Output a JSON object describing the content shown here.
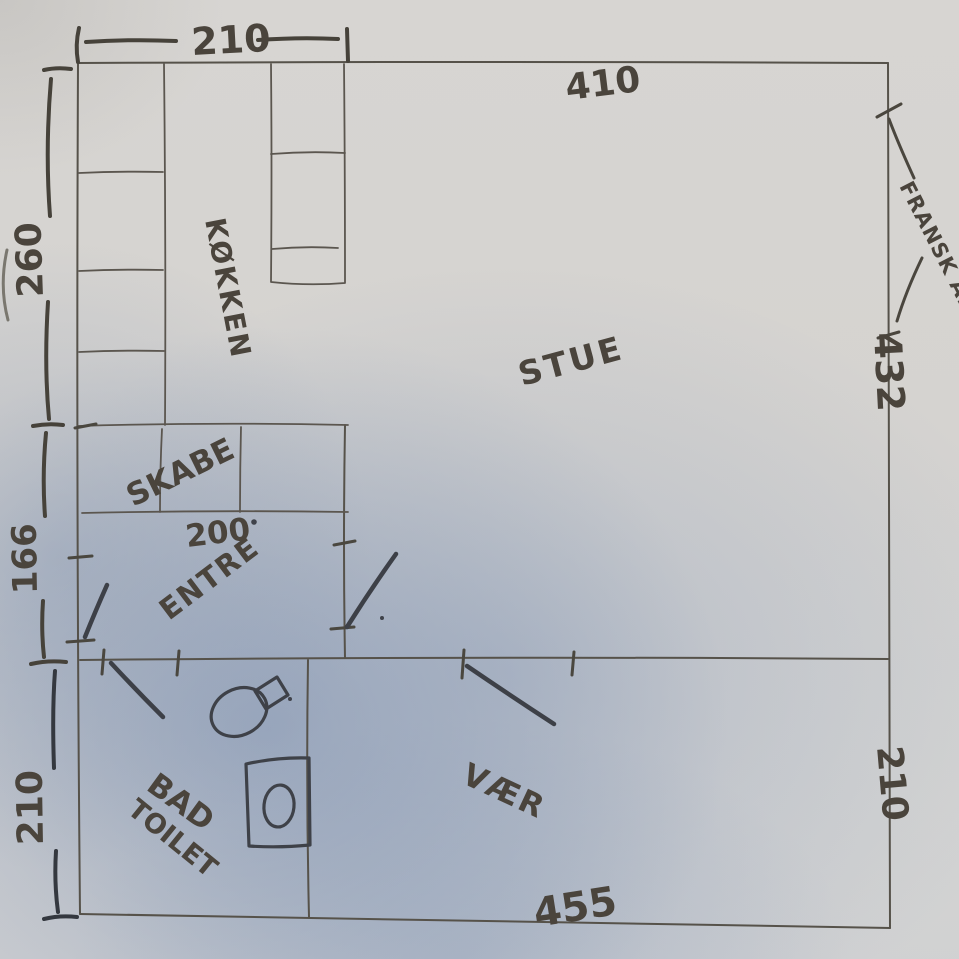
{
  "rooms": {
    "kitchen": "KØKKEN",
    "living": "STUE",
    "closets": "SKABE",
    "entry": "ENTRE",
    "bath_line1": "BAD",
    "bath_line2": "TOILET",
    "bedroom": "VÆR"
  },
  "dimensions": {
    "kitchen_width": "210",
    "living_width": "410",
    "kitchen_height": "260",
    "entry_height": "166",
    "bath_height": "210",
    "living_height": "432",
    "bedroom_height": "210",
    "bedroom_width": "455",
    "closet_width": "200"
  },
  "annotations": {
    "french_balcony": "FRANSK ALT"
  },
  "appearance": {
    "paper_color": "#d5d3d0",
    "shadow_color": "#8fa3c4",
    "pencil_color": "#56524a",
    "marker_color": "#45413a"
  }
}
